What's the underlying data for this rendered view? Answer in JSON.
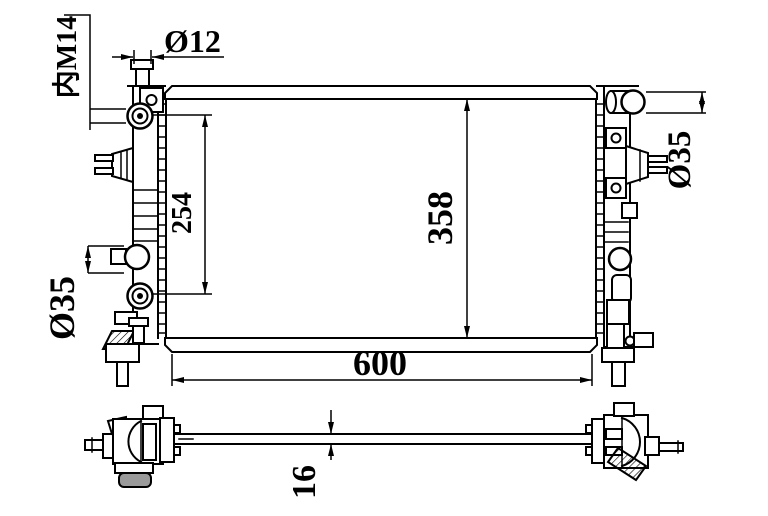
{
  "colors": {
    "line": "#000000",
    "background": "#ffffff",
    "foot_fill": "#9a9a9a"
  },
  "dims": {
    "thread_label": "内M14",
    "filler_diameter": "Ø12",
    "port_spacing": "254",
    "core_height": "358",
    "core_width": "600",
    "outlet_diameter_left": "Ø35",
    "inlet_diameter_right": "Ø35",
    "core_thickness": "16"
  }
}
